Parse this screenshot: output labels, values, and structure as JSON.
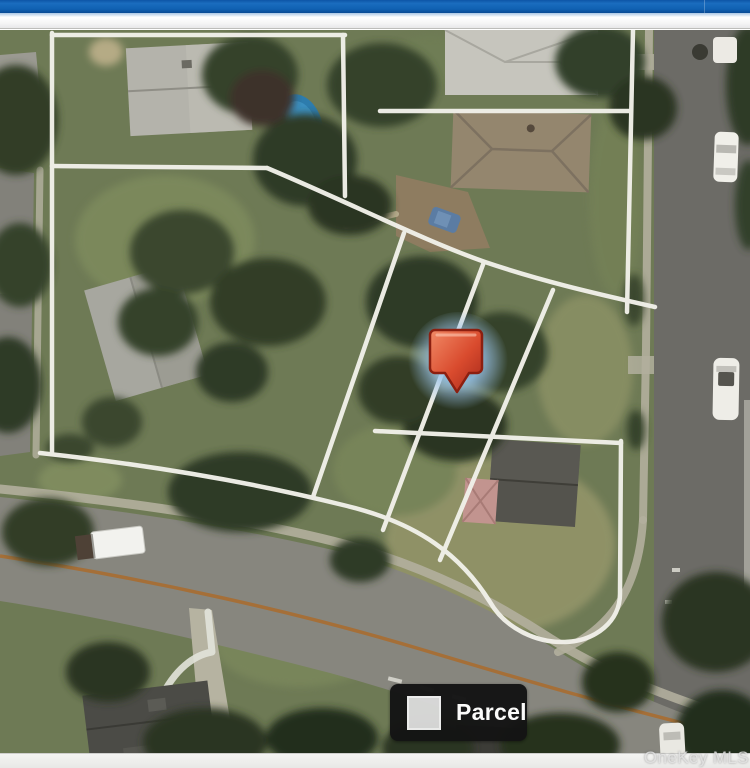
{
  "chrome": {
    "top_bar_color": "#1061b2"
  },
  "map": {
    "kind": "aerial-parcel-map",
    "parcel_line_color": "#f1f0e9",
    "road_center_line_color": "#aa6b2c",
    "marker": {
      "name": "selected-parcel-pin",
      "fill": "#d5492f",
      "border": "#8c1f10",
      "glow": "#9cc4e8"
    }
  },
  "legend": {
    "label": "Parcel",
    "swatch_color": "#d9d9d9",
    "background_color": "#141414",
    "text_color": "#ffffff"
  },
  "watermark": {
    "text": "OneKey MLS"
  }
}
